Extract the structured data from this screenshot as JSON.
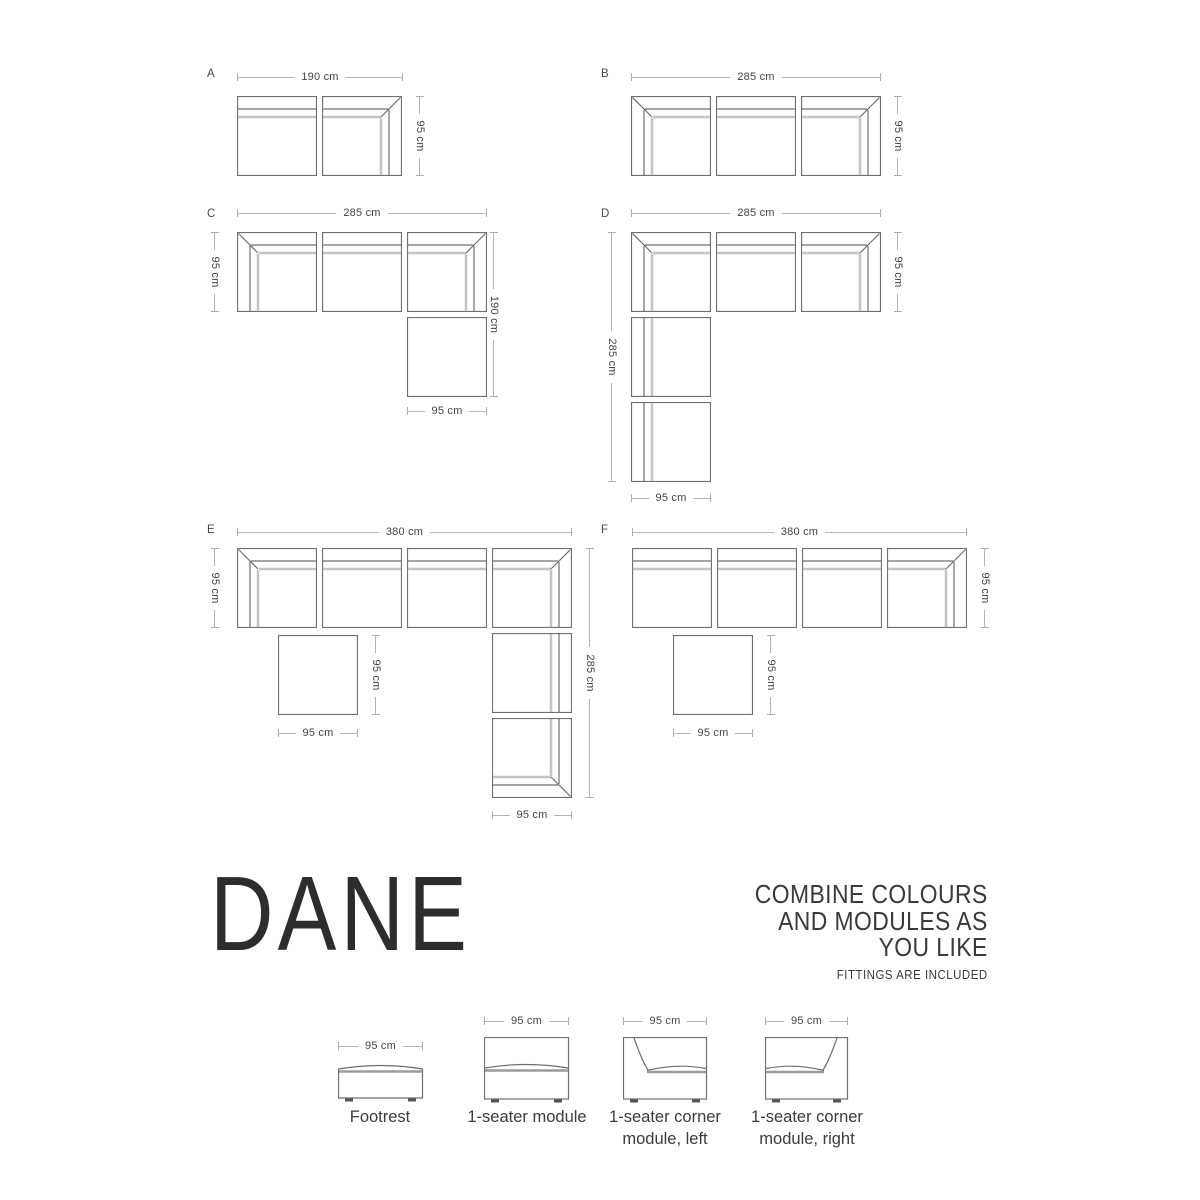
{
  "brand": {
    "name": "DANE"
  },
  "tagline": {
    "lines": [
      "COMBINE COLOURS",
      "AND MODULES AS",
      "YOU LIKE"
    ],
    "note": "FITTINGS ARE INCLUDED"
  },
  "colors": {
    "line_dark": "#6f6f6f",
    "line_light": "#c4c4c4",
    "seat_line": "#9c9c9c",
    "dim_line": "#b4b4b4",
    "dim_text": "#454545",
    "brand_text": "#2d2d2d",
    "feet": "#555555"
  },
  "layouts": [
    {
      "label": "A",
      "label_pos": {
        "x": 207,
        "y": 68
      },
      "dims": [
        {
          "orient": "h",
          "x": 237,
          "y": 77,
          "len": 166,
          "text": "190 cm"
        },
        {
          "orient": "v",
          "x": 420,
          "y": 96,
          "len": 80,
          "text": "95 cm"
        }
      ],
      "modules": [
        {
          "type": "seat-top",
          "x": 237,
          "y": 96
        },
        {
          "type": "corner-tr",
          "x": 322,
          "y": 96
        }
      ]
    },
    {
      "label": "B",
      "label_pos": {
        "x": 601,
        "y": 68
      },
      "dims": [
        {
          "orient": "h",
          "x": 631,
          "y": 77,
          "len": 250,
          "text": "285 cm"
        },
        {
          "orient": "v",
          "x": 898,
          "y": 96,
          "len": 80,
          "text": "95 cm"
        }
      ],
      "modules": [
        {
          "type": "corner-tl",
          "x": 631,
          "y": 96
        },
        {
          "type": "seat-top",
          "x": 716,
          "y": 96
        },
        {
          "type": "corner-tr",
          "x": 801,
          "y": 96
        }
      ]
    },
    {
      "label": "C",
      "label_pos": {
        "x": 207,
        "y": 208
      },
      "dims": [
        {
          "orient": "h",
          "x": 237,
          "y": 213,
          "len": 250,
          "text": "285 cm"
        },
        {
          "orient": "v",
          "x": 215,
          "y": 232,
          "len": 80,
          "text": "95 cm"
        },
        {
          "orient": "v",
          "x": 494,
          "y": 232,
          "len": 165,
          "text": "190 cm"
        },
        {
          "orient": "h",
          "x": 407,
          "y": 411,
          "len": 80,
          "text": "95 cm"
        }
      ],
      "modules": [
        {
          "type": "corner-tl",
          "x": 237,
          "y": 232
        },
        {
          "type": "seat-top",
          "x": 322,
          "y": 232
        },
        {
          "type": "corner-tr",
          "x": 407,
          "y": 232
        },
        {
          "type": "footrest",
          "x": 407,
          "y": 317
        }
      ]
    },
    {
      "label": "D",
      "label_pos": {
        "x": 601,
        "y": 208
      },
      "dims": [
        {
          "orient": "h",
          "x": 631,
          "y": 213,
          "len": 250,
          "text": "285 cm"
        },
        {
          "orient": "v",
          "x": 612,
          "y": 232,
          "len": 250,
          "text": "285 cm"
        },
        {
          "orient": "v",
          "x": 898,
          "y": 232,
          "len": 80,
          "text": "95 cm"
        },
        {
          "orient": "h",
          "x": 631,
          "y": 498,
          "len": 80,
          "text": "95 cm"
        }
      ],
      "modules": [
        {
          "type": "corner-tl",
          "x": 631,
          "y": 232
        },
        {
          "type": "seat-top",
          "x": 716,
          "y": 232
        },
        {
          "type": "corner-tr",
          "x": 801,
          "y": 232
        },
        {
          "type": "seat-left",
          "x": 631,
          "y": 317
        },
        {
          "type": "seat-left",
          "x": 631,
          "y": 402
        }
      ]
    },
    {
      "label": "E",
      "label_pos": {
        "x": 207,
        "y": 524
      },
      "dims": [
        {
          "orient": "h",
          "x": 237,
          "y": 532,
          "len": 335,
          "text": "380 cm"
        },
        {
          "orient": "v",
          "x": 215,
          "y": 548,
          "len": 80,
          "text": "95 cm"
        },
        {
          "orient": "v",
          "x": 376,
          "y": 635,
          "len": 80,
          "text": "95 cm"
        },
        {
          "orient": "h",
          "x": 278,
          "y": 733,
          "len": 80,
          "text": "95 cm"
        },
        {
          "orient": "v",
          "x": 590,
          "y": 548,
          "len": 250,
          "text": "285 cm"
        },
        {
          "orient": "h",
          "x": 492,
          "y": 815,
          "len": 80,
          "text": "95 cm"
        }
      ],
      "modules": [
        {
          "type": "corner-tl",
          "x": 237,
          "y": 548
        },
        {
          "type": "seat-top",
          "x": 322,
          "y": 548
        },
        {
          "type": "seat-top",
          "x": 407,
          "y": 548
        },
        {
          "type": "corner-tr",
          "x": 492,
          "y": 548
        },
        {
          "type": "footrest",
          "x": 278,
          "y": 635
        },
        {
          "type": "seat-right",
          "x": 492,
          "y": 633
        },
        {
          "type": "corner-br",
          "x": 492,
          "y": 718
        }
      ]
    },
    {
      "label": "F",
      "label_pos": {
        "x": 601,
        "y": 524
      },
      "dims": [
        {
          "orient": "h",
          "x": 632,
          "y": 532,
          "len": 335,
          "text": "380 cm"
        },
        {
          "orient": "v",
          "x": 985,
          "y": 548,
          "len": 80,
          "text": "95 cm"
        },
        {
          "orient": "v",
          "x": 771,
          "y": 635,
          "len": 80,
          "text": "95 cm"
        },
        {
          "orient": "h",
          "x": 673,
          "y": 733,
          "len": 80,
          "text": "95 cm"
        }
      ],
      "modules": [
        {
          "type": "seat-top",
          "x": 632,
          "y": 548
        },
        {
          "type": "seat-top",
          "x": 717,
          "y": 548
        },
        {
          "type": "seat-top",
          "x": 802,
          "y": 548
        },
        {
          "type": "corner-tr",
          "x": 887,
          "y": 548
        },
        {
          "type": "footrest",
          "x": 673,
          "y": 635
        }
      ]
    }
  ],
  "catalog": [
    {
      "type": "footrest",
      "dim": {
        "x": 338,
        "y": 1046,
        "len": 85,
        "text": "95 cm"
      },
      "box": {
        "x": 338,
        "y": 1060,
        "w": 85,
        "h": 38
      },
      "cx": 380,
      "label_lines": [
        "Footrest"
      ]
    },
    {
      "type": "seater",
      "dim": {
        "x": 484,
        "y": 1021,
        "len": 85,
        "text": "95 cm"
      },
      "box": {
        "x": 484,
        "y": 1037,
        "w": 85,
        "h": 62
      },
      "cx": 527,
      "label_lines": [
        "1-seater module"
      ]
    },
    {
      "type": "corner-left",
      "dim": {
        "x": 623,
        "y": 1021,
        "len": 84,
        "text": "95 cm"
      },
      "box": {
        "x": 623,
        "y": 1037,
        "w": 84,
        "h": 62
      },
      "cx": 665,
      "label_lines": [
        "1-seater corner",
        "module, left"
      ]
    },
    {
      "type": "corner-right",
      "dim": {
        "x": 765,
        "y": 1021,
        "len": 83,
        "text": "95 cm"
      },
      "box": {
        "x": 765,
        "y": 1037,
        "w": 83,
        "h": 62
      },
      "cx": 807,
      "label_lines": [
        "1-seater corner",
        "module, right"
      ]
    }
  ]
}
